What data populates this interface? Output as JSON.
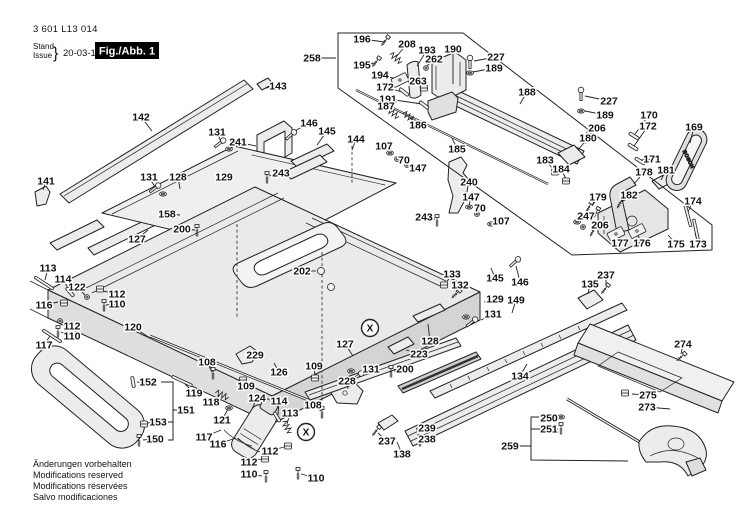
{
  "header": {
    "part_number": "3 601 L13 014",
    "stand_label": "Stand",
    "issue_label": "Issue",
    "brace": "}",
    "date": "20-03-10",
    "figure_label": "Fig./Abb. 1"
  },
  "footer": {
    "lines": [
      "Änderungen vorbehalten",
      "Modifications reserved",
      "Modifications réservées",
      "Salvo modificaciones"
    ]
  },
  "colors": {
    "ink": "#1a1a1a",
    "fill_light": "#ececec",
    "fill_mid": "#d8d8d8",
    "bg": "#ffffff",
    "fig_box": "#000000"
  },
  "figure": {
    "handle_brand": "BOSCH",
    "x_marker_text": "X",
    "x_markers": [
      [
        370,
        328
      ],
      [
        306,
        432
      ]
    ],
    "labels": [
      [
        "196",
        362,
        39,
        385,
        42
      ],
      [
        "208",
        407,
        44,
        396,
        57
      ],
      [
        "193",
        427,
        50,
        417,
        66
      ],
      [
        "190",
        453,
        49,
        453,
        84
      ],
      [
        "227",
        496,
        57,
        474,
        61
      ],
      [
        "262",
        434,
        59,
        426,
        67
      ],
      [
        "189",
        494,
        68,
        473,
        72
      ],
      [
        "195",
        362,
        65,
        375,
        63
      ],
      [
        "194",
        380,
        75,
        397,
        79
      ],
      [
        "263",
        418,
        81,
        423,
        87
      ],
      [
        "172",
        385,
        87,
        402,
        92
      ],
      [
        "191",
        388,
        99,
        422,
        104
      ],
      [
        "187",
        386,
        106,
        394,
        112
      ],
      [
        "186",
        418,
        125,
        410,
        118
      ],
      [
        "188",
        527,
        92,
        520,
        104
      ],
      [
        "258",
        312,
        58,
        336,
        58
      ],
      [
        "227",
        609,
        101,
        585,
        96
      ],
      [
        "189",
        605,
        115,
        585,
        111
      ],
      [
        "206",
        597,
        128,
        587,
        136
      ],
      [
        "180",
        588,
        138,
        578,
        150
      ],
      [
        "170",
        649,
        115,
        635,
        134
      ],
      [
        "172",
        648,
        126,
        634,
        146
      ],
      [
        "169",
        694,
        127,
        690,
        143
      ],
      [
        "171",
        652,
        159,
        641,
        160
      ],
      [
        "183",
        545,
        160,
        554,
        170
      ],
      [
        "184",
        561,
        169,
        566,
        179
      ],
      [
        "178",
        644,
        172,
        634,
        184
      ],
      [
        "181",
        666,
        170,
        661,
        180
      ],
      [
        "179",
        598,
        197,
        592,
        206
      ],
      [
        "182",
        629,
        195,
        621,
        202
      ],
      [
        "174",
        693,
        201,
        688,
        212
      ],
      [
        "247",
        586,
        216,
        579,
        221
      ],
      [
        "206",
        600,
        225,
        594,
        230
      ],
      [
        "177",
        620,
        243,
        616,
        236
      ],
      [
        "176",
        642,
        243,
        637,
        234
      ],
      [
        "175",
        676,
        244,
        668,
        235
      ],
      [
        "173",
        698,
        244,
        695,
        233
      ],
      [
        "143",
        278,
        86,
        266,
        88
      ],
      [
        "142",
        141,
        117,
        152,
        131
      ],
      [
        "131",
        217,
        132,
        221,
        142
      ],
      [
        "241",
        238,
        142,
        256,
        146
      ],
      [
        "141",
        46,
        181,
        43,
        190
      ],
      [
        "131",
        149,
        177,
        155,
        187
      ],
      [
        "128",
        178,
        177,
        180,
        189
      ],
      [
        "129",
        224,
        177,
        227,
        182
      ],
      [
        "243",
        281,
        173,
        269,
        176
      ],
      [
        "158",
        167,
        214,
        180,
        215
      ],
      [
        "200",
        182,
        229,
        195,
        230
      ],
      [
        "127",
        137,
        239,
        148,
        230
      ],
      [
        "146",
        309,
        123,
        293,
        132
      ],
      [
        "145",
        327,
        131,
        317,
        145
      ],
      [
        "144",
        356,
        139,
        352,
        150
      ],
      [
        "107",
        384,
        146,
        389,
        152
      ],
      [
        "70",
        404,
        160,
        398,
        159
      ],
      [
        "147",
        418,
        168,
        408,
        165
      ],
      [
        "185",
        457,
        149,
        452,
        138
      ],
      [
        "240",
        469,
        182,
        460,
        184
      ],
      [
        "243",
        424,
        217,
        435,
        219
      ],
      [
        "147",
        471,
        197,
        469,
        206
      ],
      [
        "70",
        480,
        208,
        477,
        213
      ],
      [
        "107",
        501,
        221,
        492,
        223
      ],
      [
        "202",
        302,
        271,
        316,
        271
      ],
      [
        "133",
        452,
        274,
        446,
        283
      ],
      [
        "132",
        460,
        285,
        456,
        292
      ],
      [
        "145",
        495,
        278,
        491,
        268
      ],
      [
        "146",
        520,
        282,
        516,
        266
      ],
      [
        "129",
        495,
        299,
        484,
        302
      ],
      [
        "131",
        493,
        314,
        481,
        320
      ],
      [
        "149",
        516,
        300,
        512,
        313
      ],
      [
        "135",
        590,
        284,
        588,
        294
      ],
      [
        "237",
        606,
        275,
        606,
        286
      ],
      [
        "128",
        430,
        341,
        428,
        324
      ],
      [
        "134",
        520,
        376,
        527,
        364
      ],
      [
        "274",
        683,
        344,
        681,
        354
      ],
      [
        "275",
        648,
        395,
        632,
        394
      ],
      [
        "273",
        647,
        407,
        670,
        409
      ],
      [
        "113",
        48,
        268,
        45,
        280
      ],
      [
        "114",
        63,
        279,
        69,
        290
      ],
      [
        "122",
        77,
        287,
        85,
        295
      ],
      [
        "112",
        117,
        294,
        103,
        291
      ],
      [
        "110",
        117,
        304,
        106,
        305
      ],
      [
        "116",
        44,
        305,
        58,
        302
      ],
      [
        "112",
        72,
        326,
        62,
        322
      ],
      [
        "110",
        72,
        336,
        61,
        332
      ],
      [
        "117",
        44,
        345,
        50,
        336
      ],
      [
        "120",
        133,
        327,
        150,
        338
      ],
      [
        "152",
        148,
        382,
        137,
        382
      ],
      [
        "151",
        186,
        410,
        null,
        null
      ],
      [
        "153",
        158,
        422,
        147,
        423
      ],
      [
        "150",
        155,
        439,
        143,
        440
      ],
      [
        "119",
        194,
        393,
        185,
        384
      ],
      [
        "118",
        211,
        402,
        219,
        396
      ],
      [
        "121",
        222,
        420,
        228,
        409
      ],
      [
        "124",
        257,
        398,
        252,
        409
      ],
      [
        "108",
        207,
        362,
        212,
        372
      ],
      [
        "229",
        255,
        355,
        246,
        358
      ],
      [
        "126",
        279,
        372,
        274,
        363
      ],
      [
        "109",
        246,
        386,
        243,
        381
      ],
      [
        "109",
        314,
        366,
        315,
        376
      ],
      [
        "127",
        345,
        344,
        353,
        356
      ],
      [
        "228",
        347,
        381,
        348,
        389
      ],
      [
        "223",
        419,
        354,
        406,
        350
      ],
      [
        "131",
        371,
        369,
        360,
        373
      ],
      [
        "200",
        405,
        369,
        394,
        371
      ],
      [
        "108",
        313,
        405,
        321,
        411
      ],
      [
        "114",
        279,
        401,
        278,
        415
      ],
      [
        "113",
        290,
        413,
        287,
        424
      ],
      [
        "117",
        204,
        437,
        221,
        430
      ],
      [
        "116",
        218,
        444,
        236,
        438
      ],
      [
        "112",
        270,
        451,
        284,
        447
      ],
      [
        "112",
        249,
        462,
        261,
        459
      ],
      [
        "110",
        249,
        474,
        262,
        476
      ],
      [
        "110",
        316,
        478,
        301,
        474
      ],
      [
        "237",
        387,
        441,
        378,
        433
      ],
      [
        "239",
        427,
        428,
        424,
        429
      ],
      [
        "238",
        427,
        439,
        424,
        440
      ],
      [
        "138",
        402,
        454,
        397,
        442
      ],
      [
        "250",
        549,
        418,
        558,
        417
      ],
      [
        "251",
        549,
        429,
        558,
        429
      ],
      [
        "259",
        510,
        446,
        528,
        446
      ]
    ],
    "glyphs": [
      [
        "screw",
        385,
        41,
        38
      ],
      [
        "spring",
        396,
        58,
        38
      ],
      [
        "screw",
        376,
        62,
        38
      ],
      [
        "bolt",
        470,
        62,
        0
      ],
      [
        "nut",
        426,
        68,
        0
      ],
      [
        "washer",
        470,
        73,
        0
      ],
      [
        "plate",
        400,
        80,
        -26
      ],
      [
        "clip",
        424,
        88,
        0
      ],
      [
        "pin",
        404,
        92,
        38
      ],
      [
        "pin",
        424,
        105,
        38
      ],
      [
        "spring",
        393,
        113,
        38
      ],
      [
        "spring",
        409,
        117,
        38
      ],
      [
        "bolt",
        581,
        94,
        0
      ],
      [
        "washer",
        581,
        111,
        0
      ],
      [
        "screw",
        587,
        138,
        20
      ],
      [
        "pin",
        634,
        136,
        32
      ],
      [
        "pin",
        633,
        147,
        32
      ],
      [
        "pin",
        640,
        161,
        32
      ],
      [
        "rod",
        688,
        216,
        75
      ],
      [
        "washer",
        577,
        222,
        0
      ],
      [
        "nut",
        583,
        227,
        0
      ],
      [
        "screw",
        593,
        231,
        28
      ],
      [
        "screw",
        589,
        207,
        28
      ],
      [
        "screw",
        596,
        213,
        28
      ],
      [
        "screw",
        620,
        203,
        28
      ],
      [
        "clip",
        555,
        172,
        0
      ],
      [
        "clip",
        566,
        181,
        0
      ],
      [
        "plate",
        616,
        234,
        -27
      ],
      [
        "plate",
        637,
        231,
        -27
      ],
      [
        "rod",
        696,
        230,
        78
      ],
      [
        "bolt",
        220,
        143,
        52
      ],
      [
        "washer",
        229,
        149,
        0
      ],
      [
        "bolt",
        155,
        188,
        52
      ],
      [
        "washer",
        163,
        194,
        0
      ],
      [
        "screw",
        267,
        178,
        0
      ],
      [
        "screw",
        197,
        231,
        0
      ],
      [
        "bolt",
        291,
        135,
        48
      ],
      [
        "washer",
        390,
        153,
        0
      ],
      [
        "nut",
        397,
        159,
        0
      ],
      [
        "nut",
        407,
        165,
        0
      ],
      [
        "screw",
        437,
        221,
        0
      ],
      [
        "washer",
        469,
        207,
        0
      ],
      [
        "nut",
        477,
        214,
        0
      ],
      [
        "washer",
        491,
        224,
        0
      ],
      [
        "circ",
        321,
        271,
        0
      ],
      [
        "circ",
        331,
        287,
        0
      ],
      [
        "rod",
        44,
        283,
        33
      ],
      [
        "pin",
        70,
        292,
        50
      ],
      [
        "nut",
        87,
        297,
        0
      ],
      [
        "clip",
        100,
        289,
        0
      ],
      [
        "screw",
        104,
        306,
        0
      ],
      [
        "clip",
        64,
        303,
        0
      ],
      [
        "nut",
        60,
        321,
        0
      ],
      [
        "screw",
        58,
        332,
        0
      ],
      [
        "rod",
        52,
        336,
        33
      ],
      [
        "pin",
        133,
        382,
        80
      ],
      [
        "clip",
        144,
        424,
        0
      ],
      [
        "screw",
        139,
        441,
        0
      ],
      [
        "rod",
        182,
        381,
        25
      ],
      [
        "spring",
        222,
        395,
        25
      ],
      [
        "washer",
        229,
        408,
        0
      ],
      [
        "pin",
        277,
        417,
        58
      ],
      [
        "spring",
        287,
        427,
        58
      ],
      [
        "screw",
        322,
        413,
        0
      ],
      [
        "clip",
        288,
        446,
        0
      ],
      [
        "clip",
        265,
        459,
        0
      ],
      [
        "screw",
        266,
        477,
        0
      ],
      [
        "screw",
        298,
        474,
        0
      ],
      [
        "screw",
        213,
        374,
        0
      ],
      [
        "clip",
        243,
        380,
        0
      ],
      [
        "clip",
        315,
        378,
        0
      ],
      [
        "washer",
        351,
        371,
        0
      ],
      [
        "bolt",
        358,
        376,
        52
      ],
      [
        "screw",
        391,
        372,
        0
      ],
      [
        "screw",
        376,
        431,
        38
      ],
      [
        "washer",
        420,
        429,
        0
      ],
      [
        "screw",
        420,
        441,
        0
      ],
      [
        "screw",
        605,
        289,
        38
      ],
      [
        "clip",
        444,
        285,
        0
      ],
      [
        "screw",
        456,
        294,
        48
      ],
      [
        "washer",
        466,
        317,
        0
      ],
      [
        "bolt",
        472,
        322,
        52
      ],
      [
        "bolt",
        515,
        262,
        48
      ],
      [
        "screw",
        681,
        357,
        48
      ],
      [
        "clip",
        625,
        393,
        0
      ],
      [
        "washer",
        561,
        417,
        0
      ],
      [
        "screw",
        561,
        429,
        0
      ]
    ],
    "brackets": [
      [
        [
          338,
          88
        ],
        [
          338,
          33
        ],
        [
          463,
          33
        ],
        [
          712,
          225
        ],
        [
          712,
          250
        ],
        [
          572,
          255
        ],
        [
          338,
          88
        ]
      ],
      [
        [
          543,
          417
        ],
        [
          531,
          417
        ],
        [
          531,
          460
        ],
        [
          628,
          461
        ]
      ],
      [
        [
          531,
          429
        ],
        [
          543,
          429
        ]
      ],
      [
        [
          519,
          446
        ],
        [
          531,
          446
        ]
      ],
      [
        [
          161,
          382
        ],
        [
          173,
          382
        ],
        [
          173,
          440
        ],
        [
          168,
          440
        ]
      ],
      [
        [
          168,
          422
        ],
        [
          173,
          422
        ]
      ],
      [
        [
          173,
          410
        ],
        [
          177,
          410
        ]
      ]
    ],
    "dashed_lines": [
      [
        352,
        146,
        352,
        183
      ],
      [
        322,
        252,
        322,
        418
      ],
      [
        237,
        224,
        237,
        318
      ]
    ]
  }
}
